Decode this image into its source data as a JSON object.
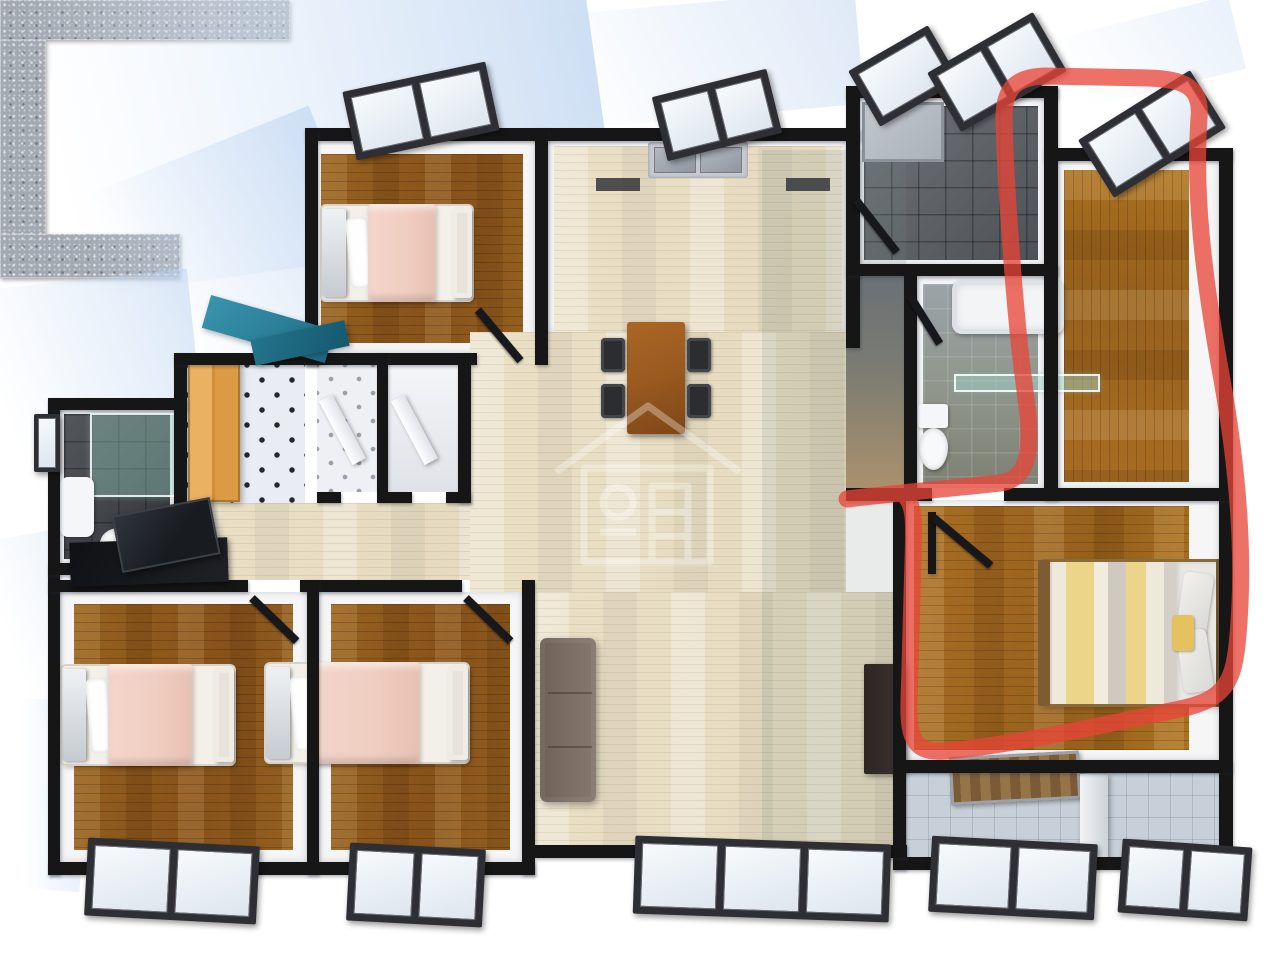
{
  "scene": {
    "description": "3D rendered top-down apartment floor plan with a red hand-drawn marker loop highlighting the right-hand master suite (walk-in wardrobe, bathroom and master bedroom)",
    "annotation": {
      "tool": "freehand-marker",
      "color": "#e84537",
      "opacity": 0.76,
      "stroke_width": 17,
      "path": "M847,499 C905,492 955,488 1000,483 C1038,478 1030,430 1023,375 C1014,305 1005,175 1004,118 C1004,92 1012,77 1045,76 L1148,78 C1183,79 1202,86 1199,118 C1194,190 1202,270 1222,380 C1238,470 1246,560 1237,645 C1233,682 1224,700 1180,709 C1100,726 1000,747 946,751 C916,753 908,742 909,702 L913,560 C914,525 915,508 906,497",
      "highlighted_area": "master-suite-right-wing"
    },
    "watermark": "house-logo"
  },
  "palette": {
    "wall": "#161616",
    "wood": "#96611f",
    "wood_orange": "#a86d24",
    "floor_light": "#eae0c6",
    "tile_dark": "#5b6066",
    "tile_balcony": "#c7d0d8",
    "granite": "#a3a9b2",
    "bed_pink": "#f0cec2",
    "bed_stripe_yellow": "#ecd488",
    "sofa_brown": "#7c6d64",
    "table_wood": "#9a5a20",
    "teal_decor": "#2a7d97",
    "wardrobe_orange": "#dc9a44",
    "glass_green": "#9fd0c3",
    "annotation_red": "#e84537",
    "shadow_blue": "#cddff2"
  },
  "rooms": [
    {
      "name": "bedroom-top-left",
      "floor": "wood-plank"
    },
    {
      "name": "kitchen",
      "floor": "light-wood"
    },
    {
      "name": "bathroom-dark-tile",
      "floor": "dark-tile"
    },
    {
      "name": "corridor",
      "floor": "mixed"
    },
    {
      "name": "bathroom-with-tub",
      "floor": "gray-tile"
    },
    {
      "name": "walk-in-wardrobe",
      "floor": "wood-plank"
    },
    {
      "name": "master-bedroom",
      "floor": "wood-plank"
    },
    {
      "name": "living-dining-area",
      "floor": "light-wood"
    },
    {
      "name": "entry-foyer",
      "floor": "diamond-tile"
    },
    {
      "name": "closet-1",
      "floor": "diamond-tile"
    },
    {
      "name": "closet-2",
      "floor": "plain"
    },
    {
      "name": "bathroom-left",
      "floor": "dark-tile"
    },
    {
      "name": "bedroom-bottom-left",
      "floor": "wood-plank"
    },
    {
      "name": "bedroom-bottom-middle",
      "floor": "wood-plank"
    },
    {
      "name": "balcony",
      "floor": "ceramic-tile"
    }
  ],
  "furniture": [
    "double-bed-pink",
    "single-bed-pink",
    "single-bed-pink",
    "master-bed-striped",
    "sofa",
    "tv-cabinet",
    "dining-table",
    "dining-chairs-x4",
    "u-shaped-kitchen-counter",
    "double-steel-sink",
    "bathtub",
    "toilet",
    "toilet",
    "pedestal-sink",
    "glass-shelf",
    "shower-enclosure",
    "shower-tray",
    "orange-wardrobe",
    "desk-with-monitor",
    "teal-sculpture",
    "balcony-bench",
    "balcony-partition"
  ]
}
